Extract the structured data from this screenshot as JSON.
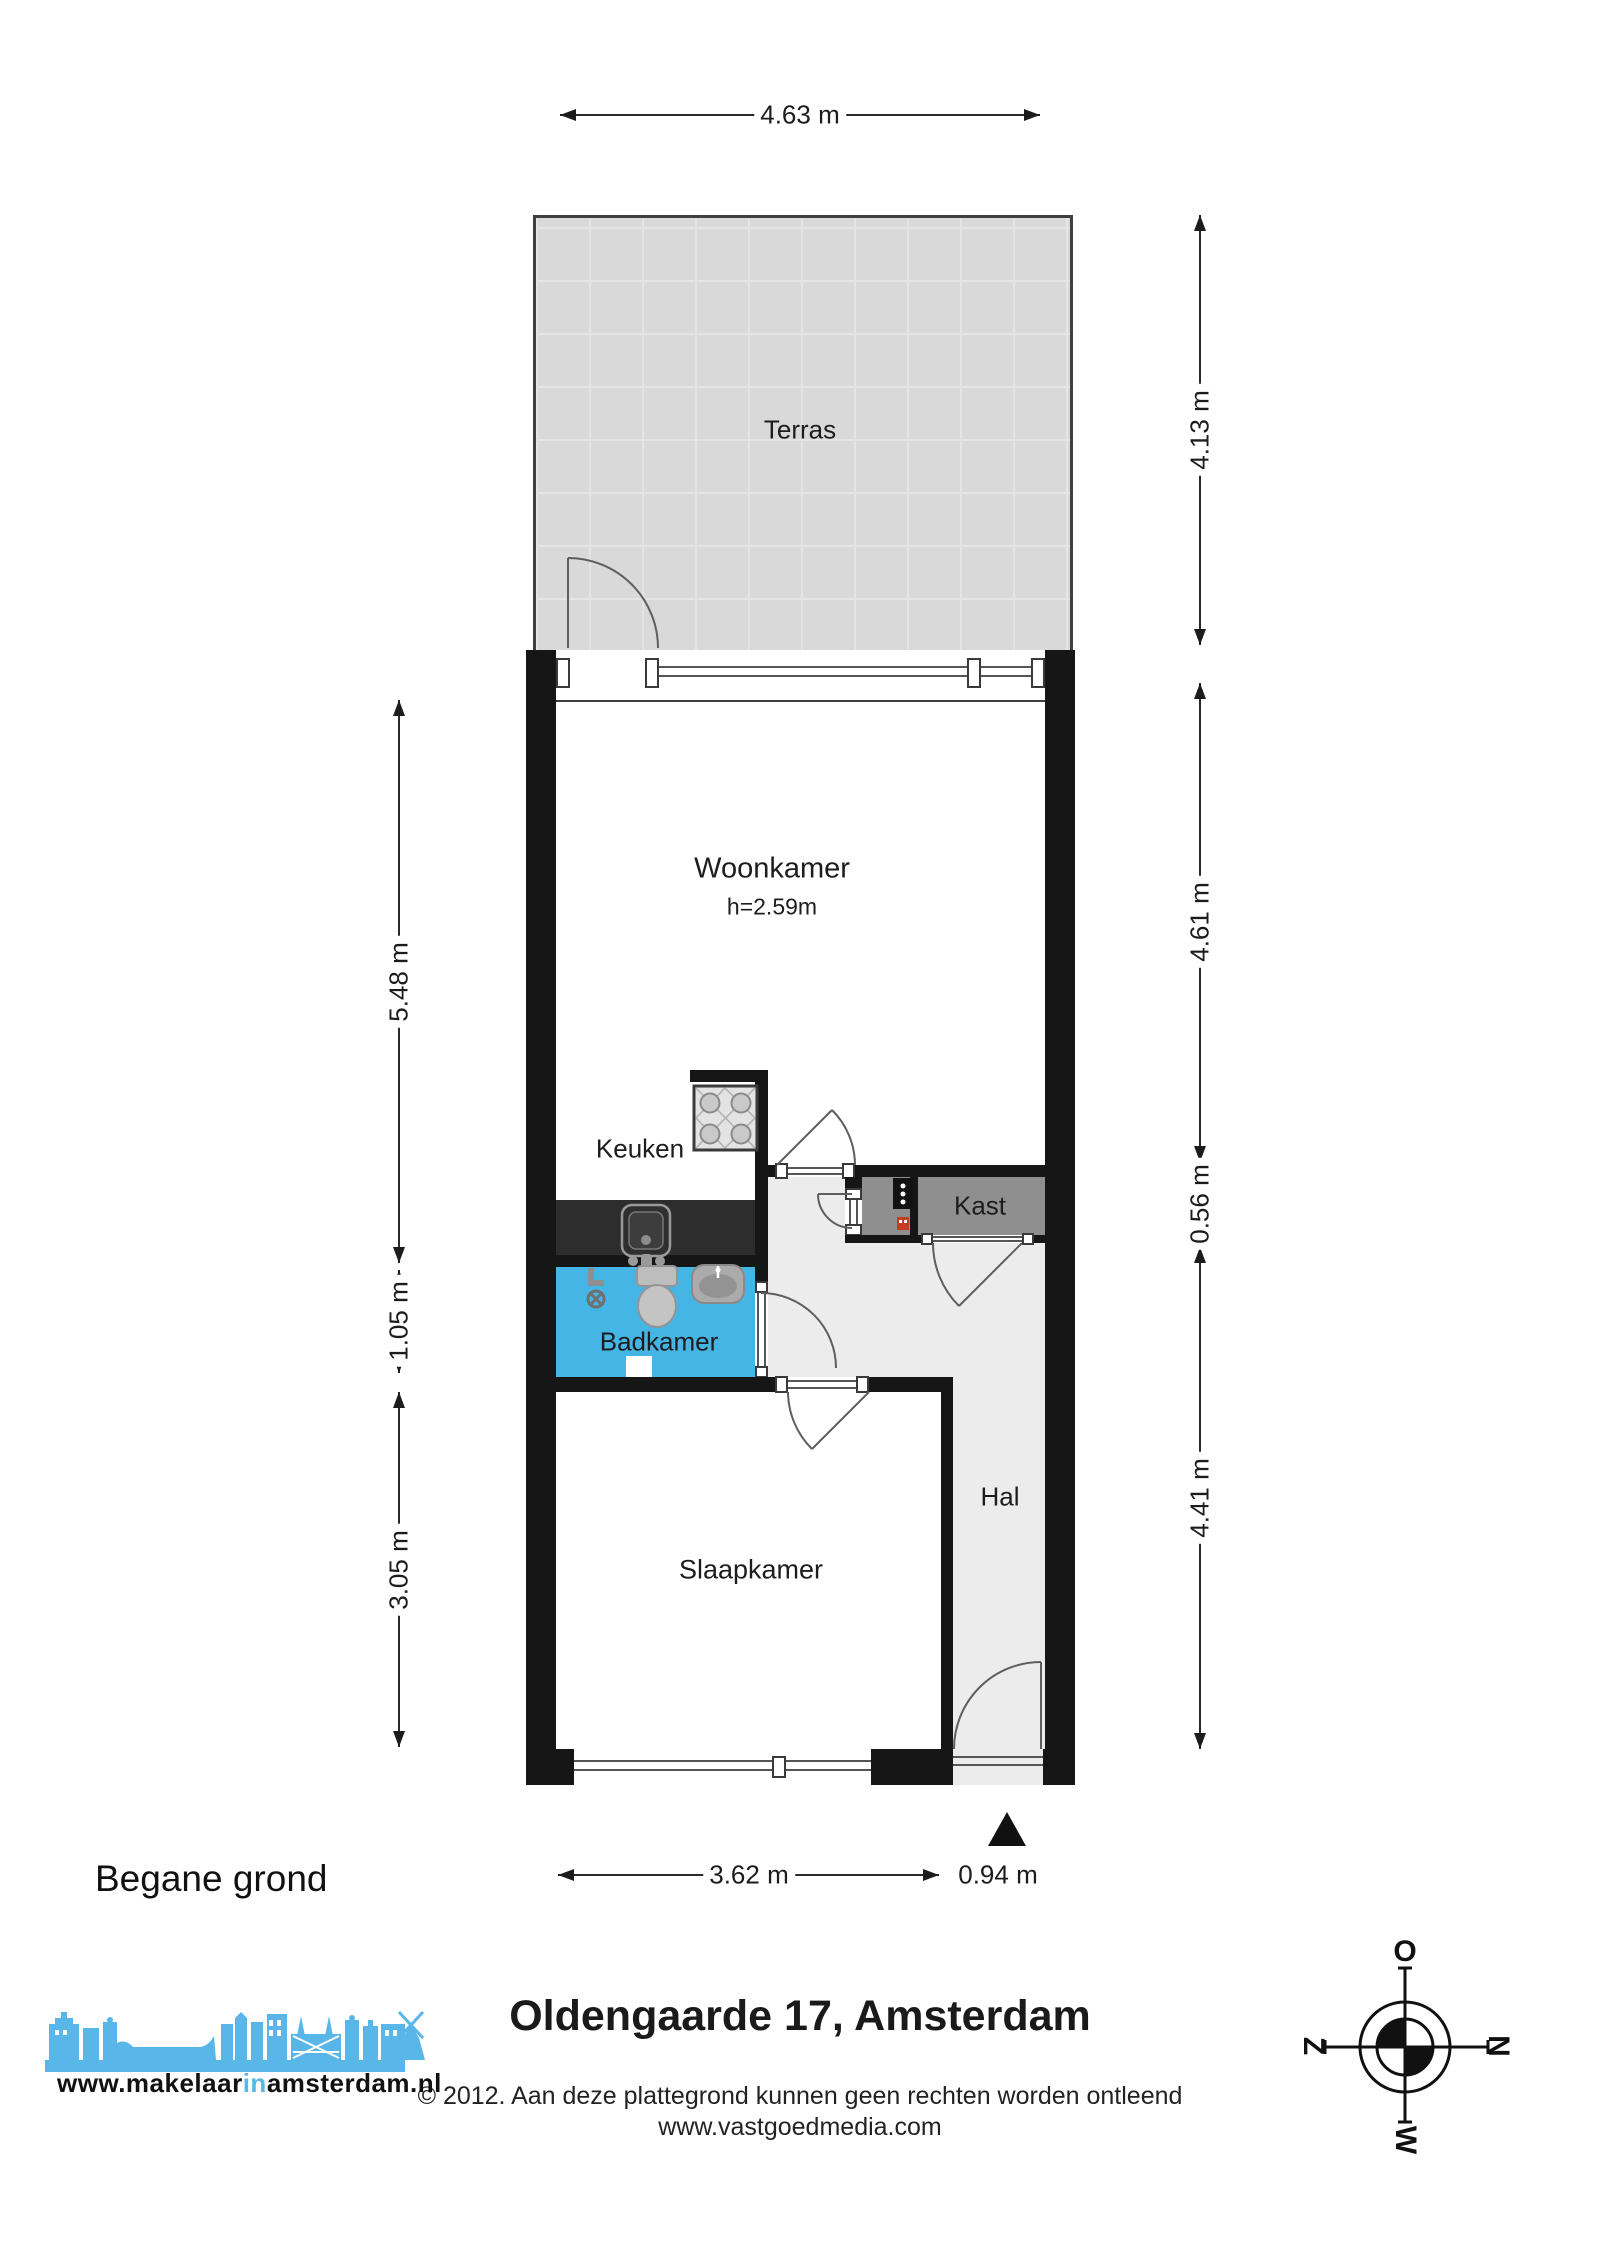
{
  "floor_label": "Begane grond",
  "title": "Oldengaarde 17, Amsterdam",
  "copyright": {
    "line1": "© 2012. Aan deze plattegrond kunnen geen rechten worden ontleend",
    "line2": "www.vastgoedmedia.com"
  },
  "logo": {
    "prefix": "www.makelaar",
    "accent": "in",
    "suffix": "amsterdam.nl"
  },
  "rooms": {
    "terras": "Terras",
    "woonkamer": "Woonkamer",
    "woonkamer_height": "h=2.59m",
    "keuken": "Keuken",
    "kast": "Kast",
    "badkamer": "Badkamer",
    "hal": "Hal",
    "slaapkamer": "Slaapkamer"
  },
  "dims": {
    "top_width": "4.63 m",
    "terras_depth": "4.13 m",
    "woonkamer_depth": "4.61 m",
    "kast_depth": "0.56 m",
    "hal_depth": "4.41 m",
    "upper_left": "5.48 m",
    "badkamer_depth": "1.05 m",
    "slaapkamer_depth": "3.05 m",
    "slaapkamer_width": "3.62 m",
    "entree_width": "0.94 m"
  },
  "compass": {
    "top": "O",
    "right": "N",
    "bottom": "W",
    "left": "Z"
  },
  "colors": {
    "wall": "#161616",
    "badkamer_blue": "#45b5e6",
    "kast_gray": "#8f8f8f",
    "hal_gray": "#ececec",
    "terras_gray": "#d9d9d9",
    "counter_dark": "#2d2d2d",
    "logo_blue": "#58b7e8",
    "boiler_red": "#c43b26"
  }
}
